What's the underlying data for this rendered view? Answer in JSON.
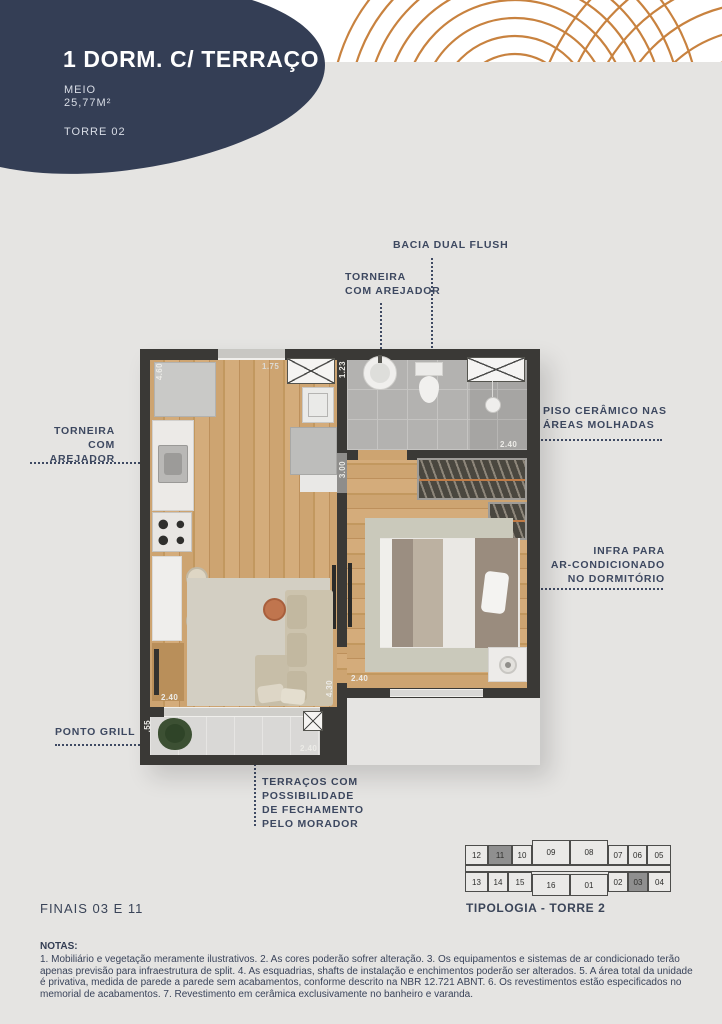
{
  "header": {
    "title": "1 DORM. C/ TERRAÇO",
    "variant": "MEIO",
    "area": "25,77M²",
    "tower": "TORRE 02",
    "blob_color": "#343e55",
    "accent_orange": "#c8823f",
    "background": "#e5e4e2"
  },
  "callouts": {
    "bacia": "BACIA DUAL FLUSH",
    "torneira_top": [
      "TORNEIRA",
      "COM AREJADOR"
    ],
    "torneira_left": [
      "TORNEIRA",
      "COM AREJADOR"
    ],
    "piso": [
      "PISO CERÂMICO NAS",
      "ÁREAS MOLHADAS"
    ],
    "infra": [
      "INFRA PARA",
      "AR-CONDICIONADO",
      "NO DORMITÓRIO"
    ],
    "grill": "PONTO GRILL",
    "terraco": [
      "TERRAÇOS COM",
      "POSSIBILIDADE",
      "DE FECHAMENTO",
      "PELO MORADOR"
    ]
  },
  "dimensions": {
    "kitchen_wall": "4.60",
    "entry_door": "1.75",
    "bath_side": "1.23",
    "bedroom_side": "3.00",
    "bath_width": "2.40",
    "bedroom_width": "2.40",
    "living_side": "4.30",
    "living_width": "2.40",
    "terrace_side": ".55",
    "terrace_width": "2.40"
  },
  "footer": {
    "finais": "FINAIS 03 E 11"
  },
  "keyplan": {
    "caption": "TIPOLOGIA - TORRE 2",
    "top_row": [
      "12",
      "11",
      "10",
      "09",
      "08",
      "07",
      "06",
      "05"
    ],
    "bottom_row": [
      "13",
      "14",
      "15",
      "16",
      "01",
      "02",
      "03",
      "04"
    ],
    "highlighted": [
      "11",
      "03"
    ],
    "highlight_color": "#8f8f8f"
  },
  "notes": {
    "heading": "NOTAS:",
    "body": "1. Mobiliário e vegetação meramente ilustrativos. 2. As cores poderão sofrer alteração. 3. Os equipamentos e sistemas de ar condicionado terão apenas previsão para infraestrutura de split. 4. As esquadrias, shafts de instalação e enchimentos poderão ser alterados. 5. A área total da unidade é privativa, medida de parede a parede sem acabamentos, conforme descrito na NBR 12.721 ABNT. 6. Os revestimentos estão especificados no memorial de acabamentos. 7. Revestimento em cerâmica exclusivamente no banheiro e varanda."
  }
}
